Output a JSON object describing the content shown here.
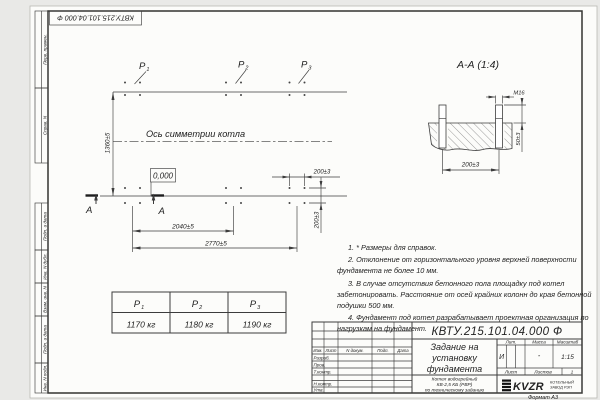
{
  "stamp": {
    "doc_number_inverted": "КВТУ.215.101.04.000  Ф"
  },
  "margins": {
    "labels": [
      "Перв. примен.",
      "Справ. N",
      "Подп. и дата",
      "Инв. N дубл.",
      "Взам. инв. N",
      "Подп. и дата",
      "Инв. N подл."
    ]
  },
  "plan": {
    "p_labels": [
      {
        "label": "P",
        "sub": "1"
      },
      {
        "label": "P",
        "sub": "2"
      },
      {
        "label": "P",
        "sub": "3"
      }
    ],
    "axis_label": "Ось симметрии котла",
    "elevation": "0,000",
    "section_letter_1": "А",
    "section_letter_2": "А",
    "dims": {
      "height": "1360±5",
      "width_mid": "2040±5",
      "width_total": "2770±5",
      "bolt_spacing_x": "200±3",
      "bolt_spacing_y": "200±3"
    }
  },
  "section": {
    "title": "А-А (1:4)",
    "thread": "М16",
    "dim_spacing": "200±3",
    "dim_protrusion": "50±3"
  },
  "notes": [
    "1. * Размеры для справок.",
    "2. Отклонение от горизонтального уровня верхней поверхности фундамента не более 10 мм.",
    "3. В случае отсутствия бетонного пола площадку под котел забетонировать. Расстояние от осей крайних колонн до края бетонной подушки 500 мм.",
    "4. Фундамент под котел разрабатывает проектная организация по нагрузкам на фундамент."
  ],
  "load_table": {
    "columns": [
      {
        "label": "P",
        "sub": "1",
        "value": "1170 кг"
      },
      {
        "label": "P",
        "sub": "2",
        "value": "1180 кг"
      },
      {
        "label": "P",
        "sub": "3",
        "value": "1190 кг"
      }
    ]
  },
  "title_block": {
    "doc_number": "КВТУ.215.101.04.000  Ф",
    "title_lines": [
      "Задание на",
      "установку",
      "фундамента"
    ],
    "subtitle_lines": [
      "Котел водогрейный",
      "КВ-2,5 КБ (РВР)",
      "по техническому заданию"
    ],
    "header_cols": [
      "Изм.",
      "Лист",
      "N докум.",
      "Подп.",
      "Дата"
    ],
    "role_rows": [
      "Разраб.",
      "Пров.",
      "Т.контр.",
      "Н.контр.",
      "Утв."
    ],
    "lit_header": "Лит.",
    "mass_header": "Масса",
    "scale_header": "Масштаб",
    "lit_value": "И",
    "mass_value": "-",
    "scale_value": "1:15",
    "sheet_label": "Лист",
    "sheets_label": "Листов",
    "sheets_value": "1",
    "logo_text": "KVZR",
    "logo_caption": [
      "КОТЕЛЬНЫЙ",
      "ЗАВОД РЭП"
    ],
    "format_label": "Формат А3"
  }
}
